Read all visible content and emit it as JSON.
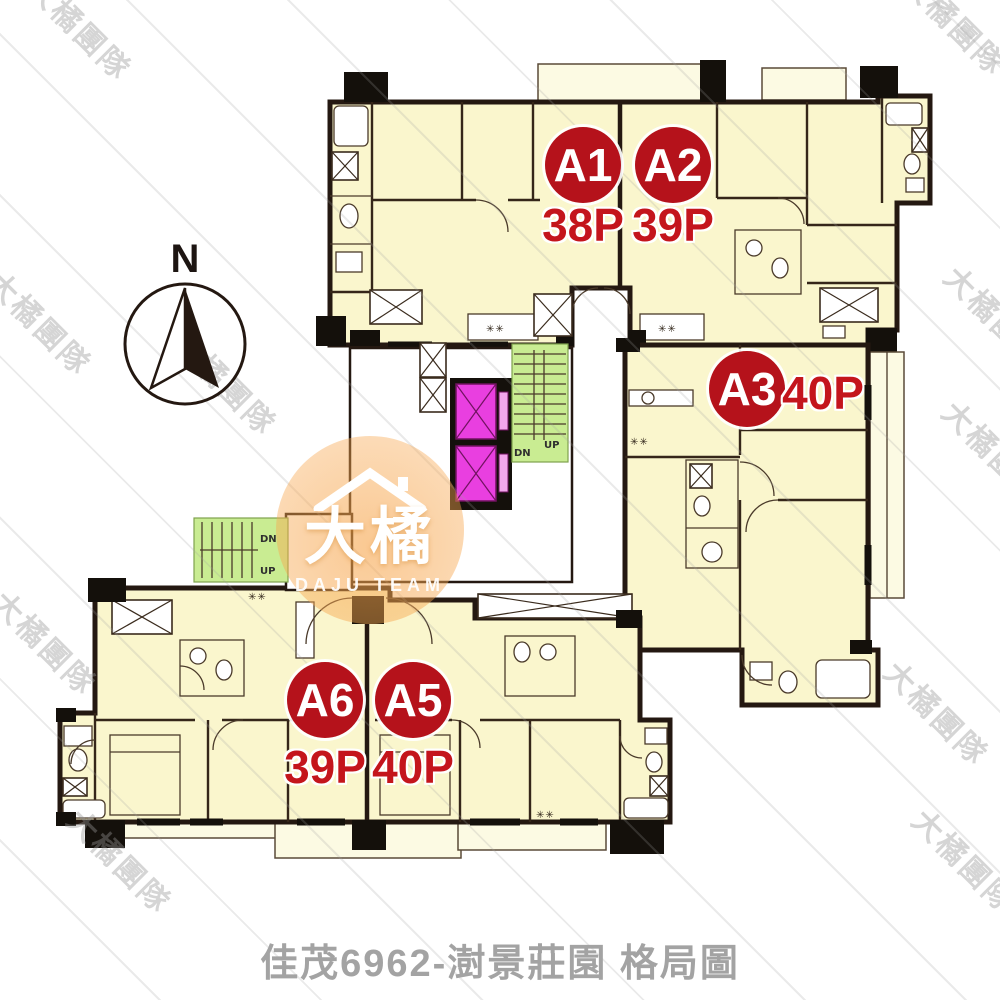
{
  "page": {
    "caption": "佳茂6962-澍景莊園 格局圖"
  },
  "compass": {
    "label": "N"
  },
  "units": [
    {
      "id": "A1",
      "area": "38P"
    },
    {
      "id": "A2",
      "area": "39P"
    },
    {
      "id": "A3",
      "area": "40P"
    },
    {
      "id": "A5",
      "area": "40P"
    },
    {
      "id": "A6",
      "area": "39P"
    }
  ],
  "core": {
    "elevators": 2,
    "stair_down_label": "DN",
    "stair_up_label": "UP",
    "stove_marker": "✳✳"
  },
  "watermark": {
    "logo_text": "大橘",
    "logo_subtext": "DAJU TEAM",
    "tile_text": "大橘團隊"
  },
  "colors": {
    "badge_red": "#B5121B",
    "area_text_red": "#C4151C",
    "room_fill": "#FAF6CD",
    "wall": "#241811",
    "elevator_magenta": "#E93FE0",
    "stair_green": "#C9EC92",
    "logo_orange": "#F7A74F",
    "caption_gray": "#A3A3A3"
  }
}
